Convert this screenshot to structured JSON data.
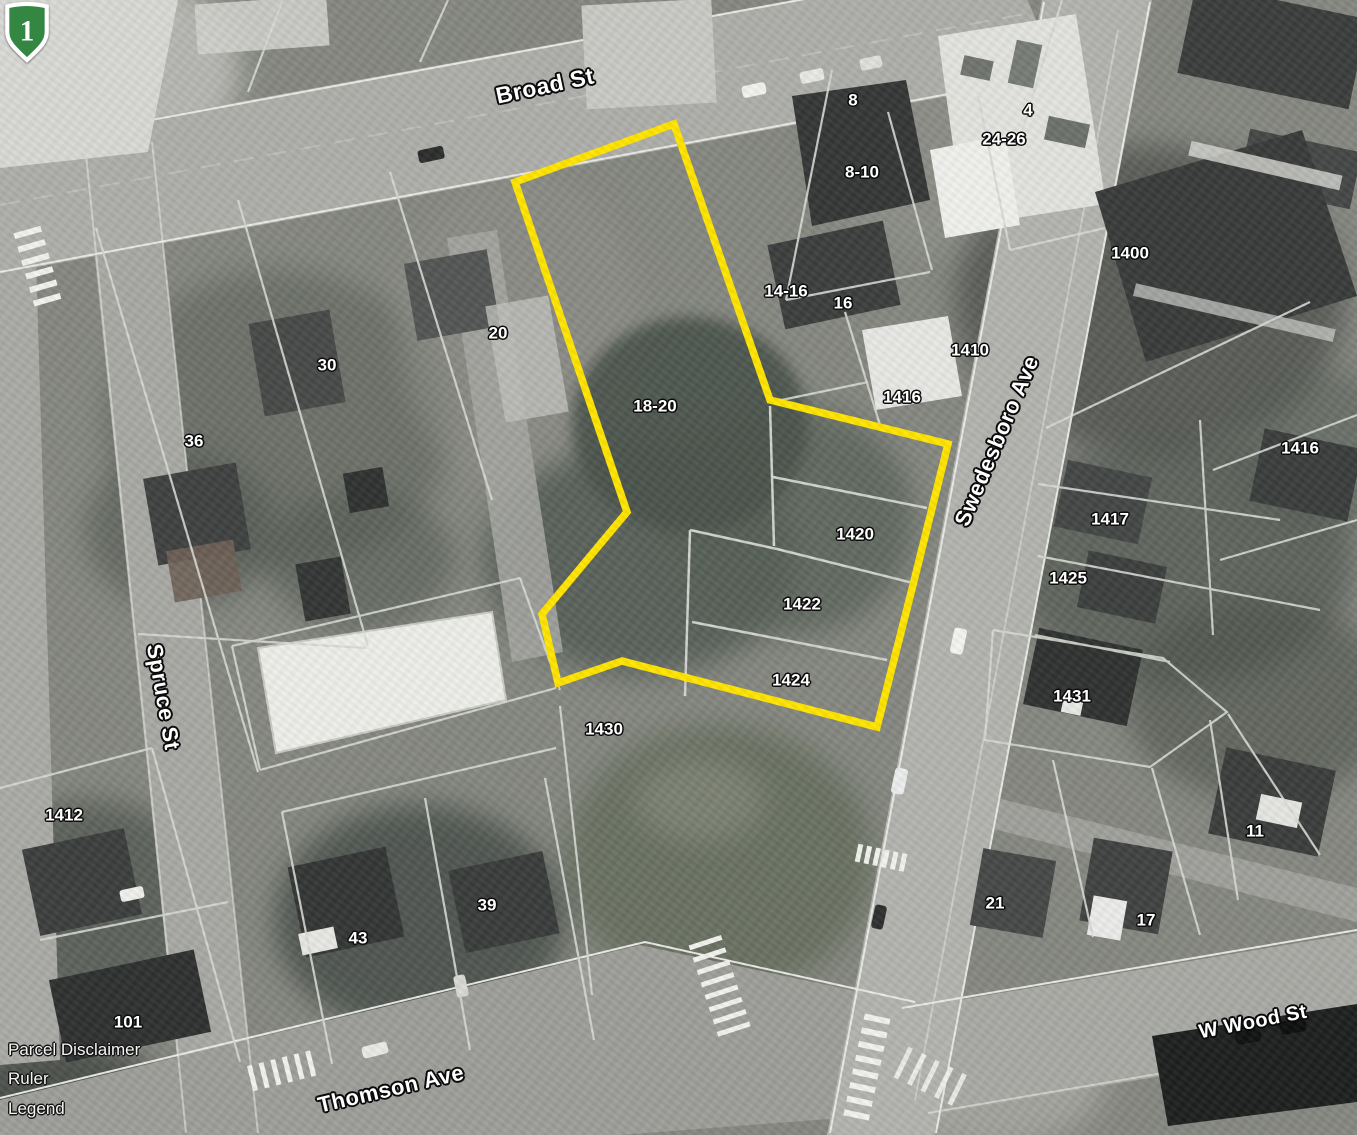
{
  "map": {
    "description": "Aerial parcel map with highlighted parcel selection",
    "streets": [
      {
        "label": "Broad St",
        "x": 545,
        "y": 86,
        "rotation": -12,
        "size": 23
      },
      {
        "label": "Spruce St",
        "x": 163,
        "y": 697,
        "rotation": 80,
        "size": 22
      },
      {
        "label": "Swedesboro Ave",
        "x": 997,
        "y": 441,
        "rotation": -67,
        "size": 22
      },
      {
        "label": "Thomson Ave",
        "x": 391,
        "y": 1089,
        "rotation": -13,
        "size": 22
      },
      {
        "label": "W Wood St",
        "x": 1253,
        "y": 1022,
        "rotation": -11,
        "size": 20
      }
    ],
    "route_shield": {
      "number": "1",
      "fill": "#338742",
      "border": "#ffffff"
    },
    "parcels": [
      {
        "text": "8",
        "x": 853,
        "y": 100
      },
      {
        "text": "4",
        "x": 1028,
        "y": 110
      },
      {
        "text": "24-26",
        "x": 1004,
        "y": 139
      },
      {
        "text": "8-10",
        "x": 862,
        "y": 172
      },
      {
        "text": "14-16",
        "x": 786,
        "y": 291
      },
      {
        "text": "16",
        "x": 843,
        "y": 303
      },
      {
        "text": "1400",
        "x": 1130,
        "y": 253
      },
      {
        "text": "1410",
        "x": 970,
        "y": 350
      },
      {
        "text": "1416",
        "x": 902,
        "y": 397
      },
      {
        "text": "20",
        "x": 498,
        "y": 333
      },
      {
        "text": "30",
        "x": 327,
        "y": 365
      },
      {
        "text": "36",
        "x": 194,
        "y": 441
      },
      {
        "text": "18-20",
        "x": 655,
        "y": 406
      },
      {
        "text": "1416",
        "x": 1300,
        "y": 448
      },
      {
        "text": "1417",
        "x": 1110,
        "y": 519
      },
      {
        "text": "1420",
        "x": 855,
        "y": 534
      },
      {
        "text": "1425",
        "x": 1068,
        "y": 578
      },
      {
        "text": "1422",
        "x": 802,
        "y": 604
      },
      {
        "text": "1424",
        "x": 791,
        "y": 680
      },
      {
        "text": "1431",
        "x": 1072,
        "y": 696
      },
      {
        "text": "1430",
        "x": 604,
        "y": 729
      },
      {
        "text": "1412",
        "x": 64,
        "y": 815
      },
      {
        "text": "11",
        "x": 1255,
        "y": 831
      },
      {
        "text": "39",
        "x": 487,
        "y": 905
      },
      {
        "text": "21",
        "x": 995,
        "y": 903
      },
      {
        "text": "43",
        "x": 358,
        "y": 938
      },
      {
        "text": "17",
        "x": 1146,
        "y": 920
      },
      {
        "text": "101",
        "x": 128,
        "y": 1022
      }
    ],
    "menu": {
      "items": [
        {
          "label": "Parcel Disclaimer"
        },
        {
          "label": "Ruler"
        },
        {
          "label": "Legend"
        }
      ]
    },
    "colors": {
      "highlight": "#FFE400",
      "parcel_line": "#d6d9d3",
      "road": "#b2b3ae",
      "ground": "#858780",
      "vegetation": "#525c54",
      "building_dark": "#3a3d3b",
      "building_light": "#e7e8e4"
    }
  }
}
